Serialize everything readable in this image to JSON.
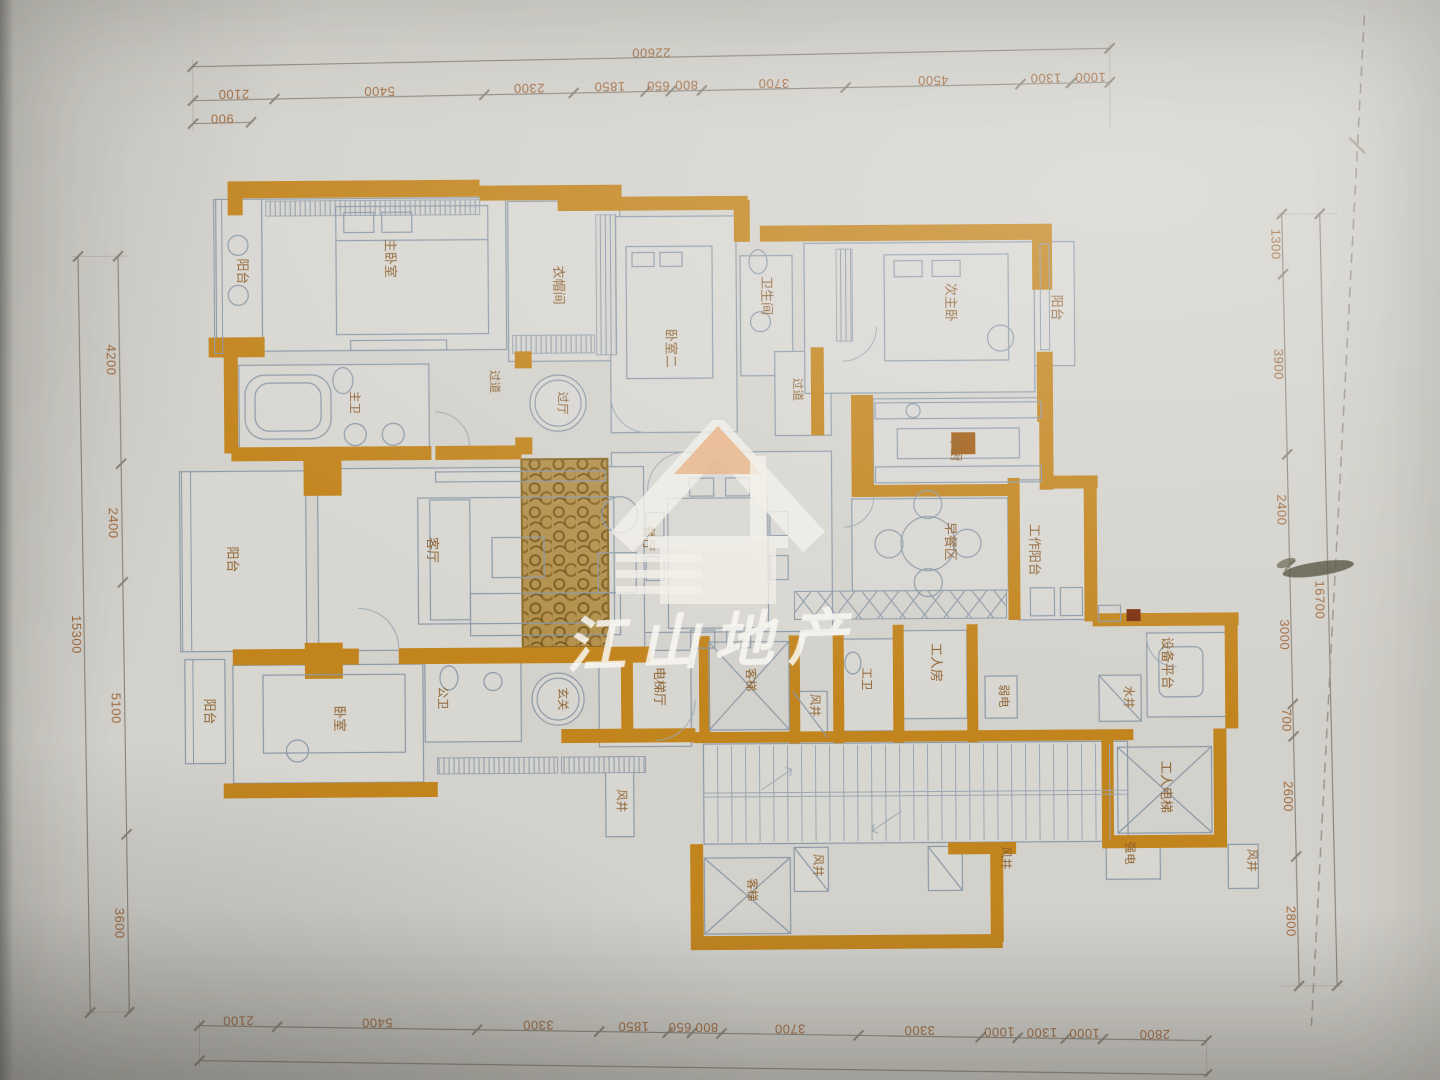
{
  "watermark": {
    "logo": "house-icon",
    "text": "江山地产"
  },
  "palette": {
    "paper": "#d3d1cb",
    "wall_orange": "#c2841d",
    "line_blue_grey": "#8b99a7",
    "dim_text": "#9c6030",
    "dim_line": "#8a8479",
    "watermark_white": "#f2efe9",
    "watermark_roof_peach": "#e9b78d"
  },
  "dimensions": {
    "top": {
      "overall": "22600",
      "sub_left": "900",
      "segments": [
        "2100",
        "5400",
        "2300",
        "1850",
        "650",
        "800",
        "3700",
        "4500",
        "1300",
        "1000"
      ]
    },
    "bottom": {
      "overall": "26100",
      "segments": [
        "2100",
        "5400",
        "3300",
        "1850",
        "650",
        "800",
        "3700",
        "3300",
        "1000",
        "1300",
        "1000",
        "2800"
      ]
    },
    "left": {
      "overall": "15300",
      "segments": [
        "4200",
        "2400",
        "5100",
        "3600"
      ]
    },
    "right": {
      "overall": "16700",
      "segments": [
        "1300",
        "3900",
        "2400",
        "3000",
        "700",
        "2600",
        "2800"
      ]
    }
  },
  "rooms": [
    {
      "name": "balcony-top-left",
      "label": "阳台"
    },
    {
      "name": "master-bedroom",
      "label": "主卧室"
    },
    {
      "name": "cloakroom",
      "label": "衣帽间"
    },
    {
      "name": "master-bathroom",
      "label": "主卫"
    },
    {
      "name": "hall",
      "label": "过厅"
    },
    {
      "name": "corridor-master",
      "label": "过道"
    },
    {
      "name": "bedroom-two",
      "label": "卧室二"
    },
    {
      "name": "bathroom",
      "label": "卫生间"
    },
    {
      "name": "corridor-right",
      "label": "过道"
    },
    {
      "name": "second-master-bedroom",
      "label": "次主卧"
    },
    {
      "name": "balcony-right",
      "label": "阳台"
    },
    {
      "name": "chinese-kitchen",
      "label": "中厨"
    },
    {
      "name": "dining-room",
      "label": "餐厅"
    },
    {
      "name": "breakfast-area",
      "label": "早餐区"
    },
    {
      "name": "work-balcony",
      "label": "工作阳台"
    },
    {
      "name": "living-room",
      "label": "客厅"
    },
    {
      "name": "balcony-left",
      "label": "阳台"
    },
    {
      "name": "foyer",
      "label": "玄关"
    },
    {
      "name": "public-bathroom",
      "label": "公卫"
    },
    {
      "name": "bedroom",
      "label": "卧室"
    },
    {
      "name": "balcony-bottom-left",
      "label": "阳台"
    },
    {
      "name": "elevator-hall",
      "label": "电梯厅"
    },
    {
      "name": "passenger-elevator",
      "label": "客梯"
    },
    {
      "name": "air-shaft-a",
      "label": "风井"
    },
    {
      "name": "worker-bathroom",
      "label": "工卫"
    },
    {
      "name": "worker-room",
      "label": "工人房"
    },
    {
      "name": "weak-electric",
      "label": "弱电"
    },
    {
      "name": "water-shaft",
      "label": "水井"
    },
    {
      "name": "equipment-platform",
      "label": "设备平台"
    },
    {
      "name": "worker-elevator",
      "label": "工人电梯"
    },
    {
      "name": "strong-electric",
      "label": "强电"
    },
    {
      "name": "passenger-elevator-lower",
      "label": "客梯"
    },
    {
      "name": "air-shaft-b",
      "label": "风井"
    },
    {
      "name": "air-shaft-c",
      "label": "风井"
    },
    {
      "name": "air-shaft-d",
      "label": "风井"
    },
    {
      "name": "air-shaft-e",
      "label": "风井"
    }
  ]
}
